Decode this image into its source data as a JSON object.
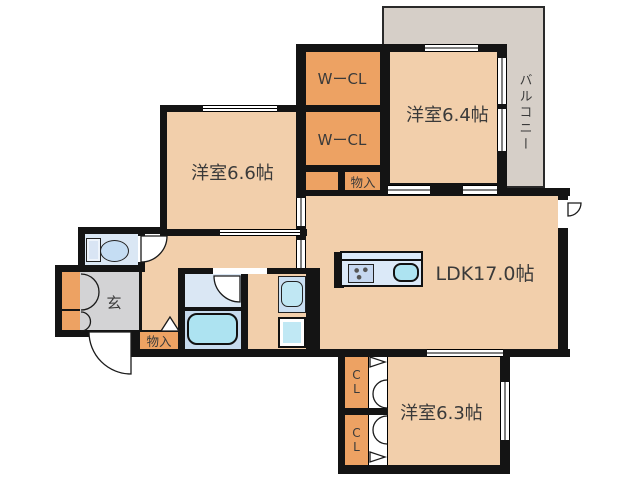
{
  "title": "apartment-floor-plan",
  "labels": {
    "balcony": "バルコニー",
    "walkin_closet_upper": "WーCL",
    "walkin_closet_lower": "WーCL",
    "bedroom_top_right": "洋室6.4帖",
    "bedroom_left": "洋室6.6帖",
    "living_dining_kitchen": "LDK17.0帖",
    "bedroom_bottom": "洋室6.3帖",
    "storage_upper": "物入",
    "storage_lower": "物入",
    "entrance": "玄",
    "closet_upper": "CL",
    "closet_lower": "CL"
  },
  "colors": {
    "room": "#F2CFAB",
    "closet": "#EDA263",
    "balcony": "#D6CFC8",
    "entrance": "#D3D3D5",
    "wetroom": "#DAE7F4",
    "wetroom_dark": "#C7DBEE",
    "counter": "#DBE9F8",
    "fixture": "#ADE3F1",
    "appliance": "#C0E8F4",
    "wall": "#141414"
  },
  "icons": {
    "toilet": "toilet-icon",
    "bathtub": "bathtub-icon",
    "washbasin": "washbasin-icon",
    "washing_machine": "washing-machine-icon",
    "stove": "stove-icon",
    "kitchen_sink": "kitchen-sink-icon"
  }
}
